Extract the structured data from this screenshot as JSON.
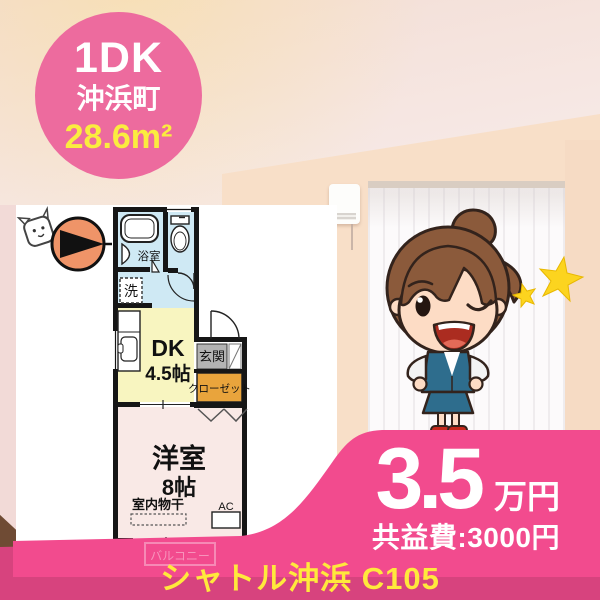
{
  "badge": {
    "layout_type": "1DK",
    "town": "沖浜町",
    "area": "28.6m²"
  },
  "compass": {
    "north_label": "N"
  },
  "floorplan": {
    "bath_label": "浴室",
    "laundry_label": "洗",
    "dk_label": "DK",
    "dk_size": "4.5帖",
    "entrance_label": "玄関",
    "closet_label": "クローゼット",
    "western_room_label": "洋室",
    "western_room_size": "8帖",
    "indoor_drying_label": "室内物干",
    "ac_label": "AC",
    "balcony_label": "バルコニー"
  },
  "price": {
    "rent_value": "3.5",
    "rent_unit": "万円",
    "common_fee": "共益費:3000円"
  },
  "footer": {
    "property_name": "シャトル沖浜 C105"
  },
  "colors": {
    "badge_pink": "#ed6b9e",
    "ribbon_pink": "#f24b8e",
    "ribbon_dark": "#d7437e",
    "accent_yellow": "#fbec3f",
    "bath_blue": "#cfe9f4",
    "dk_yellow": "#f8f5c0",
    "closet_orange": "#e9a43c",
    "room_pink": "#f9e9e6",
    "genkan_gray": "#b3b3b3",
    "compass_orange": "#ef9468",
    "star_yellow": "#fcd41f"
  }
}
